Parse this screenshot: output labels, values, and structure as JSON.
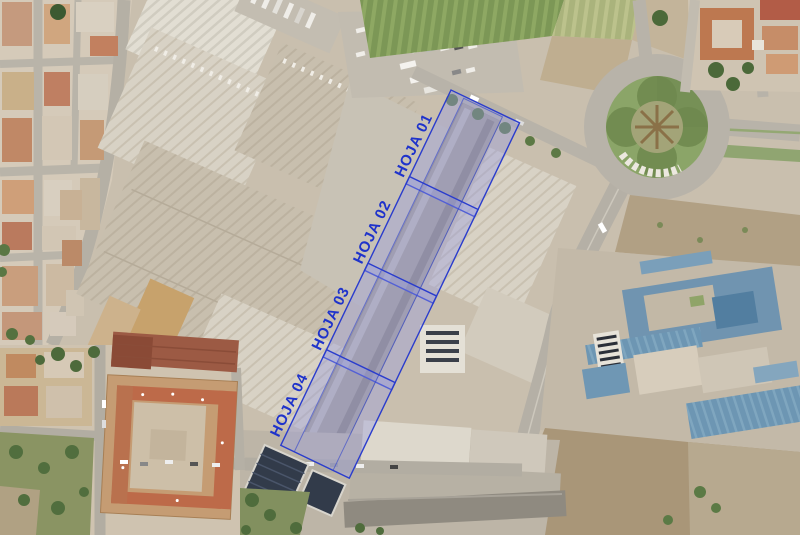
{
  "overlay": {
    "label_color": "#1f33cb",
    "stroke_color": "#2a3ccd",
    "fill_color": "rgba(150,154,226,0.38)",
    "sheets": [
      {
        "label": "HOJA 01"
      },
      {
        "label": "HOJA 02"
      },
      {
        "label": "HOJA 03"
      },
      {
        "label": "HOJA 04"
      }
    ]
  },
  "map": {
    "colors": {
      "ground": "#c9bfae",
      "road": "#b7b2a7",
      "crop_field_green": "#7c9756",
      "roundabout_green": "#8ba568",
      "warehouse_roof_tan": "#c8bfae",
      "industrial_roof_blue": "#6d96b3",
      "residential_roof_orange": "#c59c73",
      "dark_roof_red": "#9c5a44",
      "dirt_lot": "#a99678",
      "tree_green": "#4f6c3c"
    }
  }
}
